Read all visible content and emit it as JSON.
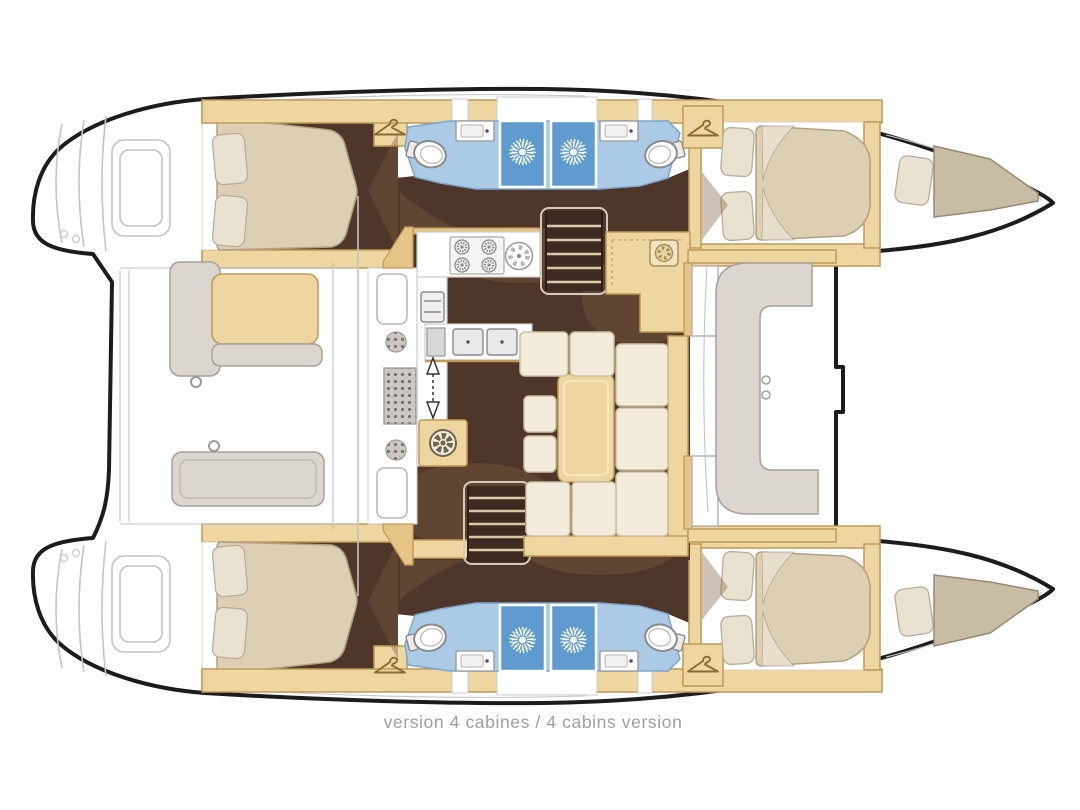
{
  "caption": {
    "text": "version 4 cabines / 4 cabins version"
  },
  "palette": {
    "outline": "#1c1c1c",
    "faintLine": "#c4c4c4",
    "tan": "#eed6a0",
    "tanDark": "#e6c487",
    "tanStroke": "#bf9a55",
    "brown": "#4e362b",
    "brownDark": "#3d2a20",
    "shade": "#7d5f43",
    "cream": "#f3ecda",
    "creamStroke": "#ccbf9f",
    "mattress": "#ddcfb4",
    "mattressStroke": "#b1a183",
    "pillow": "#e9e2d1",
    "pillowStroke": "#b6ae9b",
    "bathBlue": "#aacae5",
    "bathBlueStroke": "#7fa6c8",
    "shower": "#5f9bce",
    "bench": "#dcd6d0",
    "benchStroke": "#a7a099",
    "khaki": "#c9bca5",
    "khakiStroke": "#97896f",
    "stepLine": "#d8c8a6",
    "captionGray": "#9aa0a4"
  },
  "legend": {
    "vessel": "catamaran floor plan",
    "cabins": 4,
    "bathrooms": 4,
    "showers": 4,
    "features": [
      "stern platforms",
      "aft cockpit",
      "salon with galley",
      "navigation station",
      "U-shaped sofa",
      "twin companionway stairs",
      "forward cockpit",
      "trampoline",
      "bow sunpads"
    ]
  }
}
